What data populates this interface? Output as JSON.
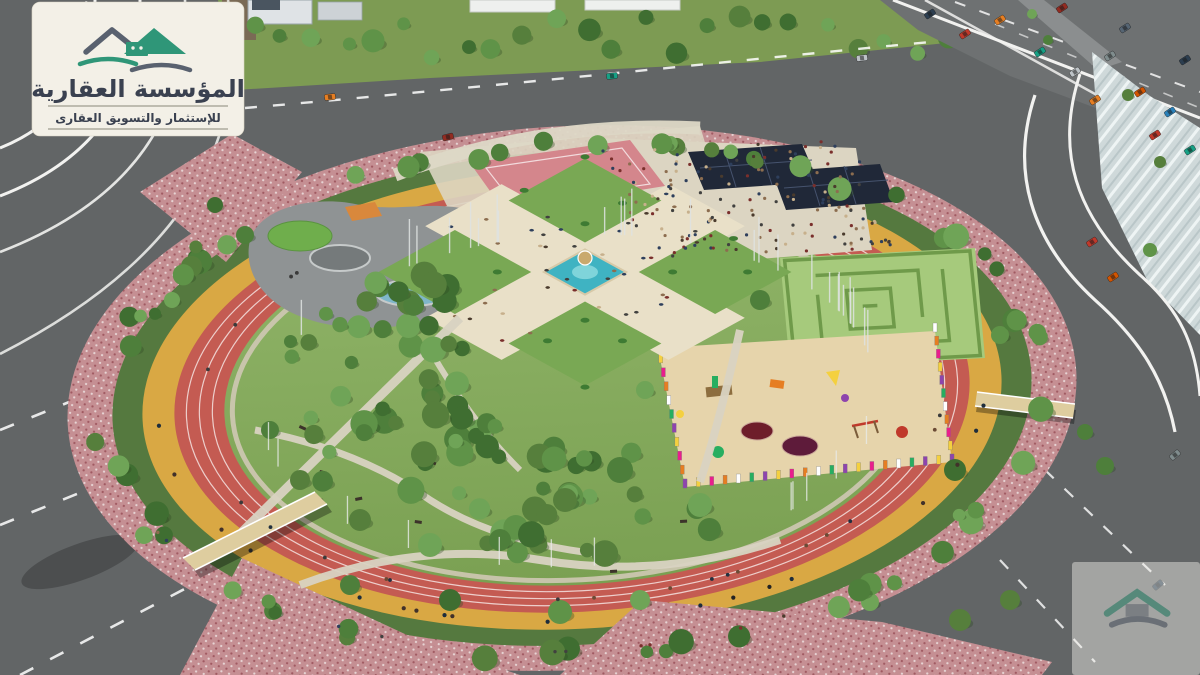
{
  "logo": {
    "title": "المؤسسة العقارية",
    "subtitle": "للإستثمار والتسويق العقارى",
    "mark_icon": "twin-peaks-house-logo-icon"
  },
  "watermark": {
    "mark_icon": "twin-peaks-house-logo-icon-faded"
  },
  "colors": {
    "asphalt": "#626566",
    "asphalt_light": "#6e7172",
    "lane_white": "#f2f2f0",
    "grass_belt": "#7d9b53",
    "grass_interior": "#86ad5c",
    "tree_belt": "#55793f",
    "mosaic_base": "#c58f93",
    "mosaic_dot_light": "#e7d4d4",
    "mosaic_dot_dark": "#a05a62",
    "track_red": "#c45b52",
    "track_yellow": "#d9a844",
    "inner_walk": "#cfc8b4",
    "plaza_cream": "#e9e0c8",
    "plaza_green": "#79a854",
    "fountain_teal": "#3fb3c2",
    "fountain_rim": "#d7c9a8",
    "maze_green": "#a6ca7c",
    "maze_wall": "#6f9a4a",
    "sand": "#e6d4ab",
    "canopy_navy": "#202838",
    "court_pink": "#d4868c",
    "skate_gray": "#8f9394",
    "splash_blue": "#7fb6c9",
    "mound_green": "#6fae4c",
    "bridge_deck": "#decd9f",
    "trampoline": "#6e1d2a",
    "paving_light": "#dcd5c2",
    "water_texture": "#cfd9da",
    "card_bg": "#f3f0e7",
    "logo_green": "#2f9678",
    "logo_gray": "#59616f",
    "logo_text": "#3a4150",
    "tree_palette": [
      "#4e7f3b",
      "#5f9348",
      "#6fa457",
      "#3f6e31",
      "#567f3c"
    ],
    "people_palette": [
      "#4a3b2d",
      "#7a2f2c",
      "#2e3f5c",
      "#c7b08c",
      "#41413f",
      "#8c6d4f"
    ],
    "car_palette": [
      "#2c3e50",
      "#c0392b",
      "#e67e22",
      "#16a085",
      "#bdc3c7",
      "#7f8c8d",
      "#d35400",
      "#2980b9",
      "#922b21",
      "#566573"
    ],
    "fence_palette": [
      "#8e44ad",
      "#f4d03f",
      "#e91e8c",
      "#e67e22",
      "#ffffff",
      "#27ae60"
    ]
  }
}
